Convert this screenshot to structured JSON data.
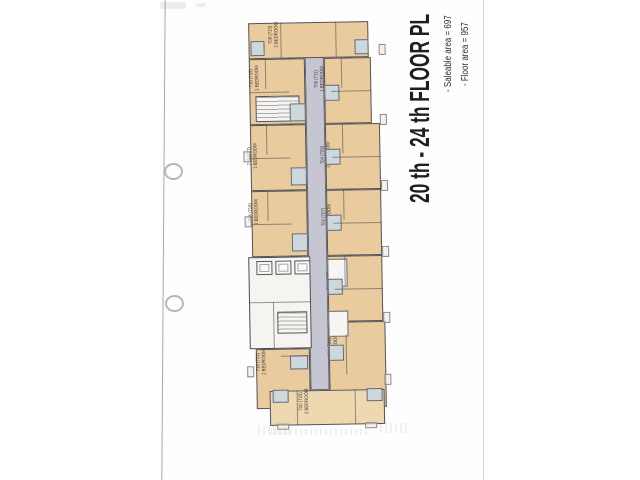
{
  "title_block": {
    "title": "20 th - 24 th FLOOR PL",
    "notes": [
      "- Saleable area = 697",
      "- Floor area = 957"
    ]
  },
  "scan": {
    "sheet_color": "#fefefe",
    "left_edge_x": 163,
    "right_edge_x": 483,
    "punch_holes": [
      {
        "x": 164,
        "y": 163
      },
      {
        "x": 165,
        "y": 295
      }
    ],
    "smudges": [
      [
        160,
        2,
        26,
        7
      ],
      [
        196,
        3,
        10,
        4
      ]
    ],
    "ghosts": [
      [
        18,
        410,
        34,
        10
      ],
      [
        140,
        408,
        30,
        10
      ],
      [
        30,
        414,
        100,
        6
      ]
    ]
  },
  "plan": {
    "colors": {
      "unit_fill": "#e9cb9e",
      "unit_fill_light": "#eed8b0",
      "corridor_fill": "#c6c6d2",
      "bath_fill": "#cdd8dc",
      "core_fill": "#f6f4f0",
      "wall": "#55545a",
      "label": "#3a3a3a"
    },
    "corridor": {
      "x": 64,
      "y": 38,
      "w": 19,
      "h": 337
    },
    "units": [
      {
        "no": "708 (713)",
        "type": "2 BEDROOM",
        "x": 8,
        "y": 7,
        "w": 120,
        "h": 36,
        "lx": 56,
        "ly": 25
      },
      {
        "no": "710 (715)",
        "type": "1 BEDROOM",
        "x": 8,
        "y": 43,
        "w": 56,
        "h": 66,
        "lx": 36,
        "ly": 68
      },
      {
        "no": "712 (717)",
        "type": "1 BEDROOM",
        "x": 8,
        "y": 109,
        "w": 56,
        "h": 66,
        "lx": 33,
        "ly": 146
      },
      {
        "no": "714 (719)",
        "type": "1 BEDROOM",
        "x": 8,
        "y": 175,
        "w": 56,
        "h": 66,
        "lx": 33,
        "ly": 202
      },
      {
        "no": "718 (723)",
        "type": "2 BEDROOM",
        "x": 10,
        "y": 333,
        "w": 54,
        "h": 60,
        "lx": 38,
        "ly": 352
      },
      {
        "no": "706 (711)",
        "type": "1 BEDROOM",
        "x": 83,
        "y": 43,
        "w": 47,
        "h": 66,
        "lx": 101,
        "ly": 70
      },
      {
        "no": "704 (709)",
        "type": "2 BEDROOM",
        "x": 83,
        "y": 109,
        "w": 55,
        "h": 66,
        "lx": 106,
        "ly": 146
      },
      {
        "no": "702 (707)",
        "type": "2 BEDROOM",
        "x": 83,
        "y": 175,
        "w": 55,
        "h": 66,
        "lx": 106,
        "ly": 208
      },
      {
        "no": "700 (705)",
        "type": "2 BEDROOM",
        "x": 83,
        "y": 241,
        "w": 55,
        "h": 66,
        "lx": 110,
        "ly": 272
      },
      {
        "no": "716 (721)",
        "type": "2 BEDROOM",
        "x": 83,
        "y": 307,
        "w": 57,
        "h": 86,
        "lx": 110,
        "ly": 338
      },
      {
        "no": "720 (725)",
        "type": "2 BEDROOM",
        "x": 23,
        "y": 375,
        "w": 115,
        "h": 35,
        "lx": 80,
        "ly": 392,
        "fill": "#eed8b0"
      }
    ],
    "core": {
      "x": 4,
      "y": 241,
      "w": 62,
      "h": 92
    },
    "elevators": [
      [
        12,
        245,
        16,
        14
      ],
      [
        31,
        245,
        16,
        14
      ],
      [
        50,
        245,
        16,
        14
      ]
    ],
    "stairs": [
      [
        14,
        80,
        44,
        26
      ],
      [
        32,
        296,
        30,
        22
      ]
    ],
    "white_rooms": [
      [
        83,
        244,
        20,
        28
      ],
      [
        83,
        296,
        20,
        26
      ]
    ],
    "bathrooms": [
      [
        10,
        25,
        14,
        15
      ],
      [
        114,
        25,
        14,
        15
      ],
      [
        48,
        88,
        16,
        18
      ],
      [
        48,
        152,
        16,
        18
      ],
      [
        48,
        218,
        16,
        18
      ],
      [
        83,
        70,
        15,
        16
      ],
      [
        83,
        134,
        15,
        16
      ],
      [
        83,
        200,
        15,
        16
      ],
      [
        83,
        264,
        15,
        16
      ],
      [
        83,
        330,
        15,
        16
      ],
      [
        26,
        374,
        16,
        13
      ],
      [
        120,
        374,
        16,
        13
      ],
      [
        44,
        340,
        18,
        14
      ]
    ],
    "balconies": [
      [
        138,
        30,
        7,
        11
      ],
      [
        138,
        100,
        7,
        11
      ],
      [
        138,
        166,
        7,
        11
      ],
      [
        138,
        232,
        7,
        11
      ],
      [
        138,
        298,
        7,
        11
      ],
      [
        138,
        360,
        7,
        11
      ],
      [
        1,
        135,
        7,
        11
      ],
      [
        1,
        200,
        7,
        11
      ],
      [
        1,
        350,
        7,
        11
      ],
      [
        30,
        408,
        12,
        6
      ],
      [
        118,
        408,
        12,
        6
      ]
    ],
    "partitions": [
      [
        24,
        43,
        1,
        30
      ],
      [
        8,
        76,
        40,
        1
      ],
      [
        24,
        109,
        1,
        30
      ],
      [
        8,
        142,
        40,
        1
      ],
      [
        24,
        175,
        1,
        30
      ],
      [
        8,
        208,
        40,
        1
      ],
      [
        100,
        43,
        1,
        30
      ],
      [
        90,
        76,
        40,
        1
      ],
      [
        100,
        109,
        1,
        30
      ],
      [
        90,
        142,
        48,
        1
      ],
      [
        100,
        175,
        1,
        30
      ],
      [
        90,
        208,
        48,
        1
      ],
      [
        100,
        241,
        1,
        30
      ],
      [
        90,
        274,
        48,
        1
      ],
      [
        40,
        7,
        1,
        36
      ],
      [
        95,
        7,
        1,
        36
      ],
      [
        35,
        340,
        28,
        1
      ],
      [
        100,
        320,
        1,
        40
      ],
      [
        50,
        375,
        1,
        35
      ],
      [
        108,
        375,
        1,
        35
      ],
      [
        4,
        286,
        62,
        1
      ],
      [
        28,
        286,
        1,
        47
      ]
    ]
  }
}
